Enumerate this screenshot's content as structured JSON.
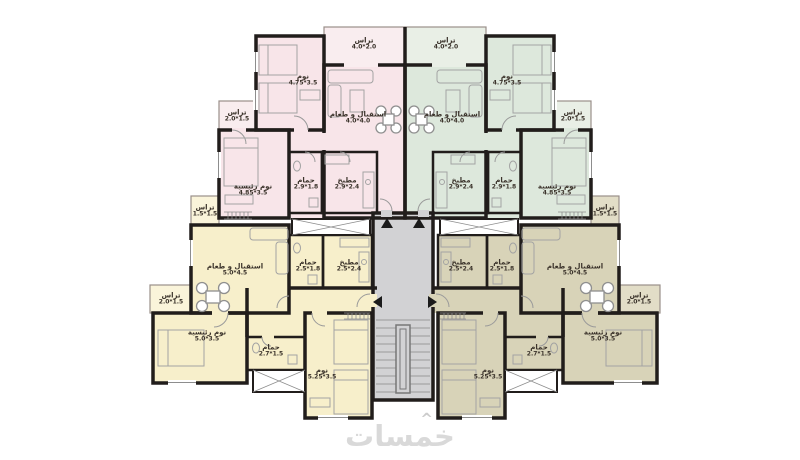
{
  "watermark": {
    "text": "خمسات",
    "mark": "^"
  },
  "apartments": {
    "top_left": {
      "terrace_top": {
        "label": "تراس",
        "dims": "4.0*2.0"
      },
      "bedroom": {
        "label": "نوم",
        "dims": "4.75*3.5"
      },
      "reception": {
        "label": "استقبال و طعام",
        "dims": "4.0*4.0"
      },
      "terrace_side": {
        "label": "تراس",
        "dims": "2.0*1.5"
      },
      "master": {
        "label": "نوم رئيسية",
        "dims": "4.85*3.5"
      },
      "bath": {
        "label": "حمام",
        "dims": "2.9*1.8"
      },
      "kitchen": {
        "label": "مطبخ",
        "dims": "2.9*2.4"
      }
    },
    "top_right": {
      "terrace_top": {
        "label": "تراس",
        "dims": "4.0*2.0"
      },
      "bedroom": {
        "label": "نوم",
        "dims": "4.75*3.5"
      },
      "reception": {
        "label": "استقبال و طعام",
        "dims": "4.0*4.0"
      },
      "terrace_side": {
        "label": "تراس",
        "dims": "2.0*1.5"
      },
      "master": {
        "label": "نوم رئيسية",
        "dims": "4.85*3.5"
      },
      "bath": {
        "label": "حمام",
        "dims": "2.9*1.8"
      },
      "kitchen": {
        "label": "مطبخ",
        "dims": "2.9*2.4"
      }
    },
    "bottom_left": {
      "terrace_tiny": {
        "label": "تراس",
        "dims": "1.5*1.5"
      },
      "reception": {
        "label": "استقبال و طعام",
        "dims": "5.0*4.5"
      },
      "bath": {
        "label": "حمام",
        "dims": "2.5*1.8"
      },
      "kitchen": {
        "label": "مطبخ",
        "dims": "2.5*2.4"
      },
      "terrace_side": {
        "label": "تراس",
        "dims": "2.0*1.5"
      },
      "master": {
        "label": "نوم رئيسية",
        "dims": "5.0*3.5"
      },
      "bath_inner": {
        "label": "حمام",
        "dims": "2.7*1.5"
      },
      "bedroom": {
        "label": "نوم",
        "dims": "5.25*3.5"
      }
    },
    "bottom_right": {
      "terrace_tiny": {
        "label": "تراس",
        "dims": "1.5*1.5"
      },
      "reception": {
        "label": "استقبال و طعام",
        "dims": "5.0*4.5"
      },
      "bath": {
        "label": "حمام",
        "dims": "2.5*1.8"
      },
      "kitchen": {
        "label": "مطبخ",
        "dims": "2.5*2.4"
      },
      "terrace_side": {
        "label": "تراس",
        "dims": "2.0*1.5"
      },
      "master": {
        "label": "نوم رئيسية",
        "dims": "5.0*3.5"
      },
      "bath_inner": {
        "label": "حمام",
        "dims": "2.7*1.5"
      },
      "bedroom": {
        "label": "نوم",
        "dims": "5.25*3.5"
      }
    }
  },
  "colors": {
    "pink": "#f8e5e9",
    "mint": "#dde8dc",
    "cream": "#f7efcb",
    "olive": "#d8d3b8",
    "core": "#d2d2d4",
    "wall": "#211d1b"
  }
}
